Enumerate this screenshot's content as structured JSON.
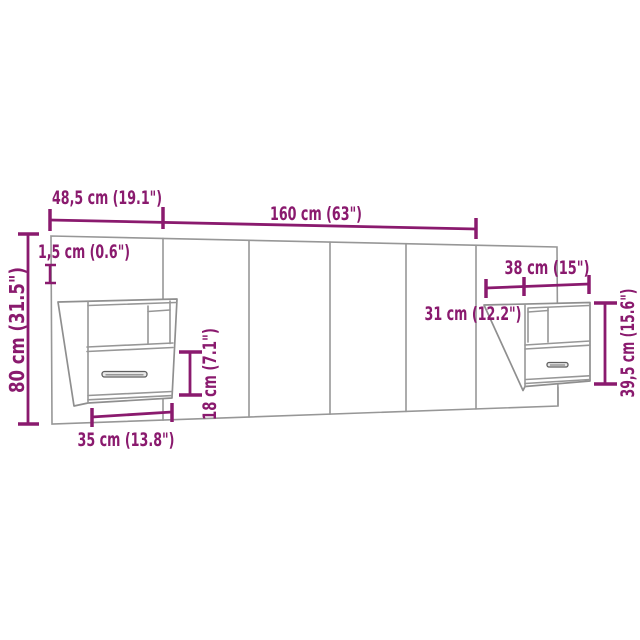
{
  "diagram": {
    "type": "product-dimension-diagram",
    "subject": "wall-mounted headboard with two floating bedside cabinets with drawer",
    "background_color": "#ffffff",
    "furniture_line_color": "#979797",
    "dimension_color": "#8a1a6e",
    "labels": {
      "left_section_width": "48,5 cm (19.1\")",
      "center_section_width": "160 cm (63\")",
      "panel_thickness": "1,5 cm (0.6\")",
      "headboard_height": "80 cm (31.5\")",
      "cabinet_total_width": "38 cm (15\")",
      "cabinet_depth": "31 cm (12.2\")",
      "drawer_height": "18 cm (7.1\")",
      "cabinet_front_width": "35 cm (13.8\")",
      "cabinet_height": "39,5 cm (15.6\")"
    }
  }
}
